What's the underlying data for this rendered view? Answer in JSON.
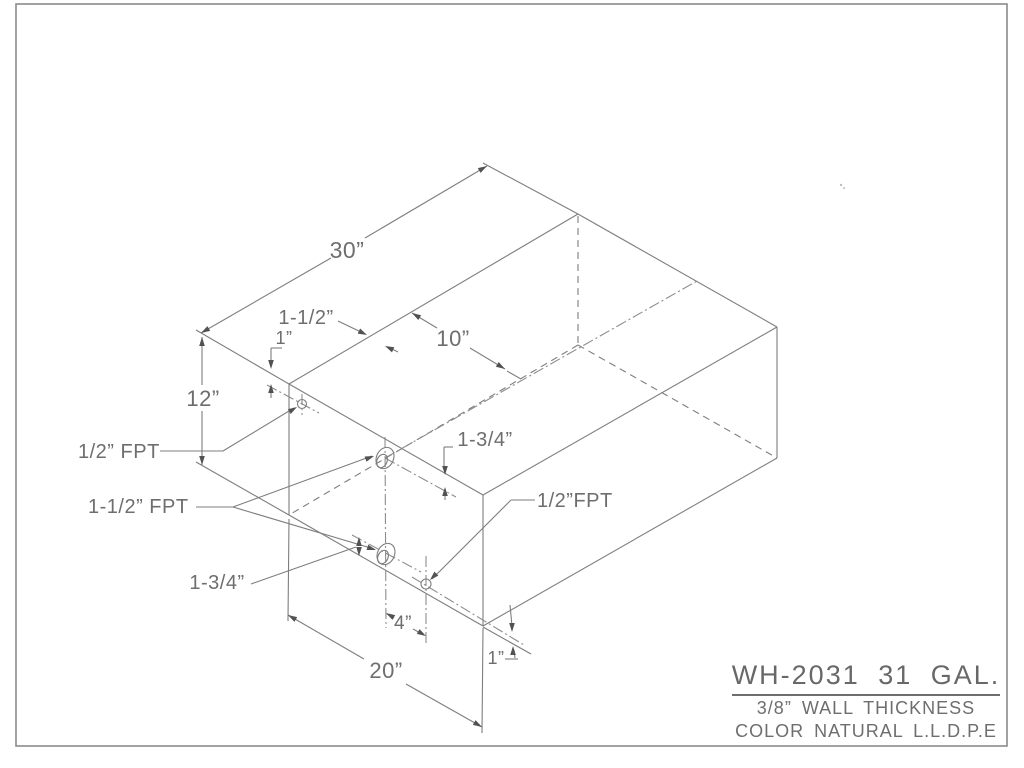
{
  "page": {
    "background": "#ffffff",
    "border_color": "#8a8a8a",
    "line_color": "#7e7e7e",
    "center_color": "#8c8c8c",
    "text_color": "#6e6e6e",
    "arrow_color": "#525252"
  },
  "border": {
    "x": 16,
    "y": 4,
    "w": 991,
    "h": 742
  },
  "title_block": {
    "model": "WH-2031 31 GAL.",
    "wall": "3/8” WALL THICKNESS",
    "color": "COLOR NATURAL L.L.D.P.E"
  },
  "drawing": {
    "lines": [
      {
        "name": "edge-top-back-left",
        "x1": 289,
        "y1": 384,
        "x2": 578,
        "y2": 214,
        "style": "solid"
      },
      {
        "name": "edge-top-back-right",
        "x1": 578,
        "y1": 214,
        "x2": 777,
        "y2": 327,
        "style": "solid"
      },
      {
        "name": "edge-top-front-right",
        "x1": 777,
        "y1": 327,
        "x2": 483,
        "y2": 495,
        "style": "solid"
      },
      {
        "name": "edge-top-front-left",
        "x1": 483,
        "y1": 495,
        "x2": 289,
        "y2": 384,
        "style": "solid"
      },
      {
        "name": "edge-vertical-left",
        "x1": 289,
        "y1": 384,
        "x2": 289,
        "y2": 515,
        "style": "solid"
      },
      {
        "name": "edge-vertical-front",
        "x1": 483,
        "y1": 495,
        "x2": 483,
        "y2": 626,
        "style": "solid"
      },
      {
        "name": "edge-vertical-right",
        "x1": 777,
        "y1": 327,
        "x2": 777,
        "y2": 458,
        "style": "solid"
      },
      {
        "name": "edge-bottom-front-left",
        "x1": 289,
        "y1": 515,
        "x2": 483,
        "y2": 626,
        "style": "solid"
      },
      {
        "name": "edge-bottom-front-right",
        "x1": 483,
        "y1": 626,
        "x2": 777,
        "y2": 458,
        "style": "solid"
      },
      {
        "name": "edge-vertical-back-hidden",
        "x1": 578,
        "y1": 216,
        "x2": 578,
        "y2": 345,
        "style": "dashed"
      },
      {
        "name": "edge-bottom-back-left-hidden",
        "x1": 578,
        "y1": 345,
        "x2": 289,
        "y2": 515,
        "style": "dashed"
      },
      {
        "name": "edge-bottom-back-right-hidden",
        "x1": 578,
        "y1": 345,
        "x2": 777,
        "y2": 458,
        "style": "dashed"
      },
      {
        "name": "ext-30-left",
        "x1": 196,
        "y1": 330,
        "x2": 289,
        "y2": 384,
        "style": "solid"
      },
      {
        "name": "ext-30-right",
        "x1": 483,
        "y1": 163,
        "x2": 578,
        "y2": 214,
        "style": "solid"
      },
      {
        "name": "dim-30-line-a",
        "x1": 201,
        "y1": 333,
        "x2": 331,
        "y2": 258,
        "style": "solid"
      },
      {
        "name": "dim-30-line-b",
        "x1": 365,
        "y1": 238,
        "x2": 487,
        "y2": 166,
        "style": "solid"
      },
      {
        "name": "dim-12-line-a",
        "x1": 202,
        "y1": 337,
        "x2": 202,
        "y2": 385,
        "style": "solid"
      },
      {
        "name": "dim-12-line-b",
        "x1": 202,
        "y1": 411,
        "x2": 202,
        "y2": 465,
        "style": "solid"
      },
      {
        "name": "ext-12-bottom",
        "x1": 196,
        "y1": 462,
        "x2": 289,
        "y2": 515,
        "style": "solid"
      },
      {
        "name": "dim-10-line-a",
        "x1": 412,
        "y1": 313,
        "x2": 437,
        "y2": 328,
        "style": "solid"
      },
      {
        "name": "dim-10-line-b",
        "x1": 470,
        "y1": 348,
        "x2": 505,
        "y2": 369,
        "style": "solid"
      },
      {
        "name": "dim-10-overshoot",
        "x1": 507,
        "y1": 371,
        "x2": 521,
        "y2": 379,
        "style": "solid"
      },
      {
        "name": "leader-1-1-2",
        "x1": 338,
        "y1": 321,
        "x2": 363,
        "y2": 333,
        "style": "solid"
      },
      {
        "name": "arrow-tail-1-1-2",
        "x1": 388,
        "y1": 347,
        "x2": 398,
        "y2": 352,
        "style": "solid"
      },
      {
        "name": "bracket-1in-h",
        "x1": 271,
        "y1": 348,
        "x2": 282,
        "y2": 348,
        "style": "solid"
      },
      {
        "name": "bracket-1in-v",
        "x1": 271,
        "y1": 348,
        "x2": 271,
        "y2": 364,
        "style": "solid"
      },
      {
        "name": "arrow-tail-1in-up",
        "x1": 271,
        "y1": 389,
        "x2": 271,
        "y2": 398,
        "style": "solid"
      },
      {
        "name": "leader-half-fpt-h",
        "x1": 160,
        "y1": 451,
        "x2": 223,
        "y2": 451,
        "style": "solid"
      },
      {
        "name": "leader-half-fpt-diag",
        "x1": 223,
        "y1": 451,
        "x2": 294,
        "y2": 408,
        "style": "solid"
      },
      {
        "name": "leader-1-1-2-fpt-h",
        "x1": 196,
        "y1": 507,
        "x2": 233,
        "y2": 507,
        "style": "solid"
      },
      {
        "name": "leader-fitting-a",
        "x1": 233,
        "y1": 507,
        "x2": 372,
        "y2": 456,
        "style": "solid"
      },
      {
        "name": "leader-fitting-b",
        "x1": 233,
        "y1": 507,
        "x2": 374,
        "y2": 549,
        "style": "solid"
      },
      {
        "name": "leader-1-3-4-bottom",
        "x1": 251,
        "y1": 584,
        "x2": 356,
        "y2": 547,
        "style": "solid"
      },
      {
        "name": "bracket-1-3-4-top-h",
        "x1": 444,
        "y1": 447,
        "x2": 453,
        "y2": 447,
        "style": "solid"
      },
      {
        "name": "bracket-1-3-4-top-v",
        "x1": 444,
        "y1": 447,
        "x2": 444,
        "y2": 470,
        "style": "solid"
      },
      {
        "name": "arrow-tail-1-3-4-up",
        "x1": 445,
        "y1": 489,
        "x2": 445,
        "y2": 500,
        "style": "solid"
      },
      {
        "name": "leader-half-fpt2-h",
        "x1": 535,
        "y1": 500,
        "x2": 511,
        "y2": 500,
        "style": "solid"
      },
      {
        "name": "leader-half-fpt2-diag",
        "x1": 511,
        "y1": 500,
        "x2": 432,
        "y2": 579,
        "style": "solid"
      },
      {
        "name": "dim-4-line-a",
        "x1": 387,
        "y1": 614,
        "x2": 394,
        "y2": 618,
        "style": "solid"
      },
      {
        "name": "dim-4-line-b",
        "x1": 413,
        "y1": 629,
        "x2": 424,
        "y2": 635,
        "style": "solid"
      },
      {
        "name": "dim-20-line-a",
        "x1": 288,
        "y1": 615,
        "x2": 364,
        "y2": 659,
        "style": "solid"
      },
      {
        "name": "dim-20-line-b",
        "x1": 406,
        "y1": 684,
        "x2": 482,
        "y2": 727,
        "style": "solid"
      },
      {
        "name": "ext-20-left",
        "x1": 289,
        "y1": 519,
        "x2": 288,
        "y2": 621,
        "style": "solid"
      },
      {
        "name": "ext-20-right",
        "x1": 483,
        "y1": 628,
        "x2": 482,
        "y2": 733,
        "style": "solid"
      },
      {
        "name": "edge-ext-front-corner",
        "x1": 483,
        "y1": 627,
        "x2": 531,
        "y2": 654,
        "style": "solid"
      },
      {
        "name": "tick-1in-br",
        "x1": 505,
        "y1": 659,
        "x2": 518,
        "y2": 659,
        "style": "solid"
      },
      {
        "name": "arrow-tail-1in-br-up",
        "x1": 514,
        "y1": 650,
        "x2": 515,
        "y2": 658,
        "style": "solid"
      },
      {
        "name": "arrow-tail-1in-br-down",
        "x1": 510,
        "y1": 605,
        "x2": 512,
        "y2": 626,
        "style": "solid"
      },
      {
        "name": "centerline-fittings-vertical",
        "x1": 385,
        "y1": 437,
        "x2": 386,
        "y2": 628,
        "style": "center"
      },
      {
        "name": "centerline-top-face-long",
        "x1": 385,
        "y1": 458,
        "x2": 697,
        "y2": 281,
        "style": "center"
      },
      {
        "name": "centerline-fitting-a-diag",
        "x1": 385,
        "y1": 458,
        "x2": 456,
        "y2": 497,
        "style": "center"
      },
      {
        "name": "centerline-fitting-b-diag",
        "x1": 352,
        "y1": 535,
        "x2": 421,
        "y2": 572,
        "style": "center"
      },
      {
        "name": "centerline-top-fitting-v",
        "x1": 302,
        "y1": 394,
        "x2": 302,
        "y2": 415,
        "style": "center"
      },
      {
        "name": "centerline-top-fitting-diag",
        "x1": 267,
        "y1": 385,
        "x2": 319,
        "y2": 413,
        "style": "center"
      },
      {
        "name": "centerline-drain-v",
        "x1": 426,
        "y1": 556,
        "x2": 426,
        "y2": 643,
        "style": "center"
      },
      {
        "name": "centerline-drain-diag",
        "x1": 412,
        "y1": 577,
        "x2": 524,
        "y2": 645,
        "style": "center"
      }
    ],
    "ellipses": [
      {
        "name": "fitting-a-outer",
        "cx": 385,
        "cy": 458,
        "rx": 8.5,
        "ry": 11,
        "rot": 25
      },
      {
        "name": "fitting-a-inner",
        "cx": 382,
        "cy": 461,
        "rx": 5,
        "ry": 7,
        "rot": 25
      },
      {
        "name": "fitting-b-outer",
        "cx": 386,
        "cy": 554,
        "rx": 8.5,
        "ry": 11,
        "rot": 25
      },
      {
        "name": "fitting-b-inner",
        "cx": 383,
        "cy": 557,
        "rx": 5,
        "ry": 7,
        "rot": 25
      },
      {
        "name": "top-fitting-circle",
        "cx": 302,
        "cy": 404,
        "rx": 4.5,
        "ry": 4.5,
        "rot": 0
      },
      {
        "name": "drain-fitting-circle",
        "cx": 426,
        "cy": 584,
        "rx": 5,
        "ry": 5,
        "rot": 0
      }
    ],
    "arrows": [
      {
        "name": "arrow-30-left",
        "x": 201,
        "y": 333,
        "a": 150
      },
      {
        "name": "arrow-30-right",
        "x": 487,
        "y": 166,
        "a": -30
      },
      {
        "name": "arrow-12-top",
        "x": 202,
        "y": 337,
        "a": -90
      },
      {
        "name": "arrow-12-bottom",
        "x": 202,
        "y": 465,
        "a": 90
      },
      {
        "name": "arrow-10-left",
        "x": 412,
        "y": 313,
        "a": -149
      },
      {
        "name": "arrow-10-right",
        "x": 505,
        "y": 369,
        "a": 31
      },
      {
        "name": "arrow-1-1-2",
        "x": 367,
        "y": 335,
        "a": 26
      },
      {
        "name": "arrow-1-1-2-b",
        "x": 385,
        "y": 346,
        "a": -155
      },
      {
        "name": "arrow-1in-down",
        "x": 271,
        "y": 369,
        "a": 90
      },
      {
        "name": "arrow-1in-up",
        "x": 271,
        "y": 384,
        "a": -90
      },
      {
        "name": "arrow-half-fpt",
        "x": 297,
        "y": 407,
        "a": -31
      },
      {
        "name": "arrow-fitting-a",
        "x": 374,
        "y": 456,
        "a": -20
      },
      {
        "name": "arrow-fitting-b",
        "x": 376,
        "y": 550,
        "a": 17
      },
      {
        "name": "arrow-1-3-4-top-down",
        "x": 445,
        "y": 475,
        "a": 90
      },
      {
        "name": "arrow-1-3-4-top-up",
        "x": 445,
        "y": 487,
        "a": -90
      },
      {
        "name": "arrow-1-3-4-bot-up",
        "x": 359,
        "y": 537,
        "a": -90
      },
      {
        "name": "arrow-1-3-4-bot-down",
        "x": 359,
        "y": 556,
        "a": 90
      },
      {
        "name": "arrow-half-fpt2",
        "x": 430,
        "y": 580,
        "a": 135
      },
      {
        "name": "arrow-4-left",
        "x": 386,
        "y": 613,
        "a": -150
      },
      {
        "name": "arrow-4-right",
        "x": 426,
        "y": 636,
        "a": 30
      },
      {
        "name": "arrow-20-left",
        "x": 288,
        "y": 615,
        "a": -150
      },
      {
        "name": "arrow-20-right",
        "x": 482,
        "y": 727,
        "a": 30
      },
      {
        "name": "arrow-1in-br-down",
        "x": 512,
        "y": 632,
        "a": 90
      },
      {
        "name": "arrow-1in-br-up",
        "x": 513,
        "y": 646,
        "a": -90
      }
    ],
    "labels": [
      {
        "name": "dim-30-text",
        "text": "30”",
        "x": 347,
        "y": 258,
        "size": 23,
        "anchor": "middle"
      },
      {
        "name": "dim-12-text",
        "text": "12”",
        "x": 203,
        "y": 406,
        "size": 22,
        "anchor": "middle"
      },
      {
        "name": "dim-10-text",
        "text": "10”",
        "x": 453,
        "y": 346,
        "size": 22,
        "anchor": "middle"
      },
      {
        "name": "dim-1-1-2-text",
        "text": "1-1/2”",
        "x": 306,
        "y": 324,
        "size": 20,
        "anchor": "middle"
      },
      {
        "name": "dim-1in-top-text",
        "text": "1”",
        "x": 284,
        "y": 344,
        "size": 18,
        "anchor": "middle"
      },
      {
        "name": "label-half-fpt-left",
        "text": "1/2” FPT",
        "x": 78,
        "y": 458,
        "size": 20,
        "anchor": "start"
      },
      {
        "name": "label-1-1-2-fpt",
        "text": "1-1/2” FPT",
        "x": 88,
        "y": 513,
        "size": 20,
        "anchor": "start"
      },
      {
        "name": "dim-1-3-4-top-text",
        "text": "1-3/4”",
        "x": 485,
        "y": 446,
        "size": 20,
        "anchor": "middle"
      },
      {
        "name": "dim-1-3-4-bottom-text",
        "text": "1-3/4”",
        "x": 217,
        "y": 589,
        "size": 20,
        "anchor": "middle"
      },
      {
        "name": "label-half-fpt-right",
        "text": "1/2”FPT",
        "x": 537,
        "y": 507,
        "size": 20,
        "anchor": "start"
      },
      {
        "name": "dim-4-text",
        "text": "4”",
        "x": 403,
        "y": 629,
        "size": 19,
        "anchor": "middle"
      },
      {
        "name": "dim-20-text",
        "text": "20”",
        "x": 386,
        "y": 678,
        "size": 22,
        "anchor": "middle"
      },
      {
        "name": "dim-1in-br-text",
        "text": "1”",
        "x": 496,
        "y": 664,
        "size": 18,
        "anchor": "middle"
      }
    ],
    "marks": [
      {
        "name": "paper-speck-1",
        "cx": 841,
        "cy": 185,
        "r": 1.2
      },
      {
        "name": "paper-speck-2",
        "cx": 844,
        "cy": 188,
        "r": 1.0
      }
    ]
  }
}
